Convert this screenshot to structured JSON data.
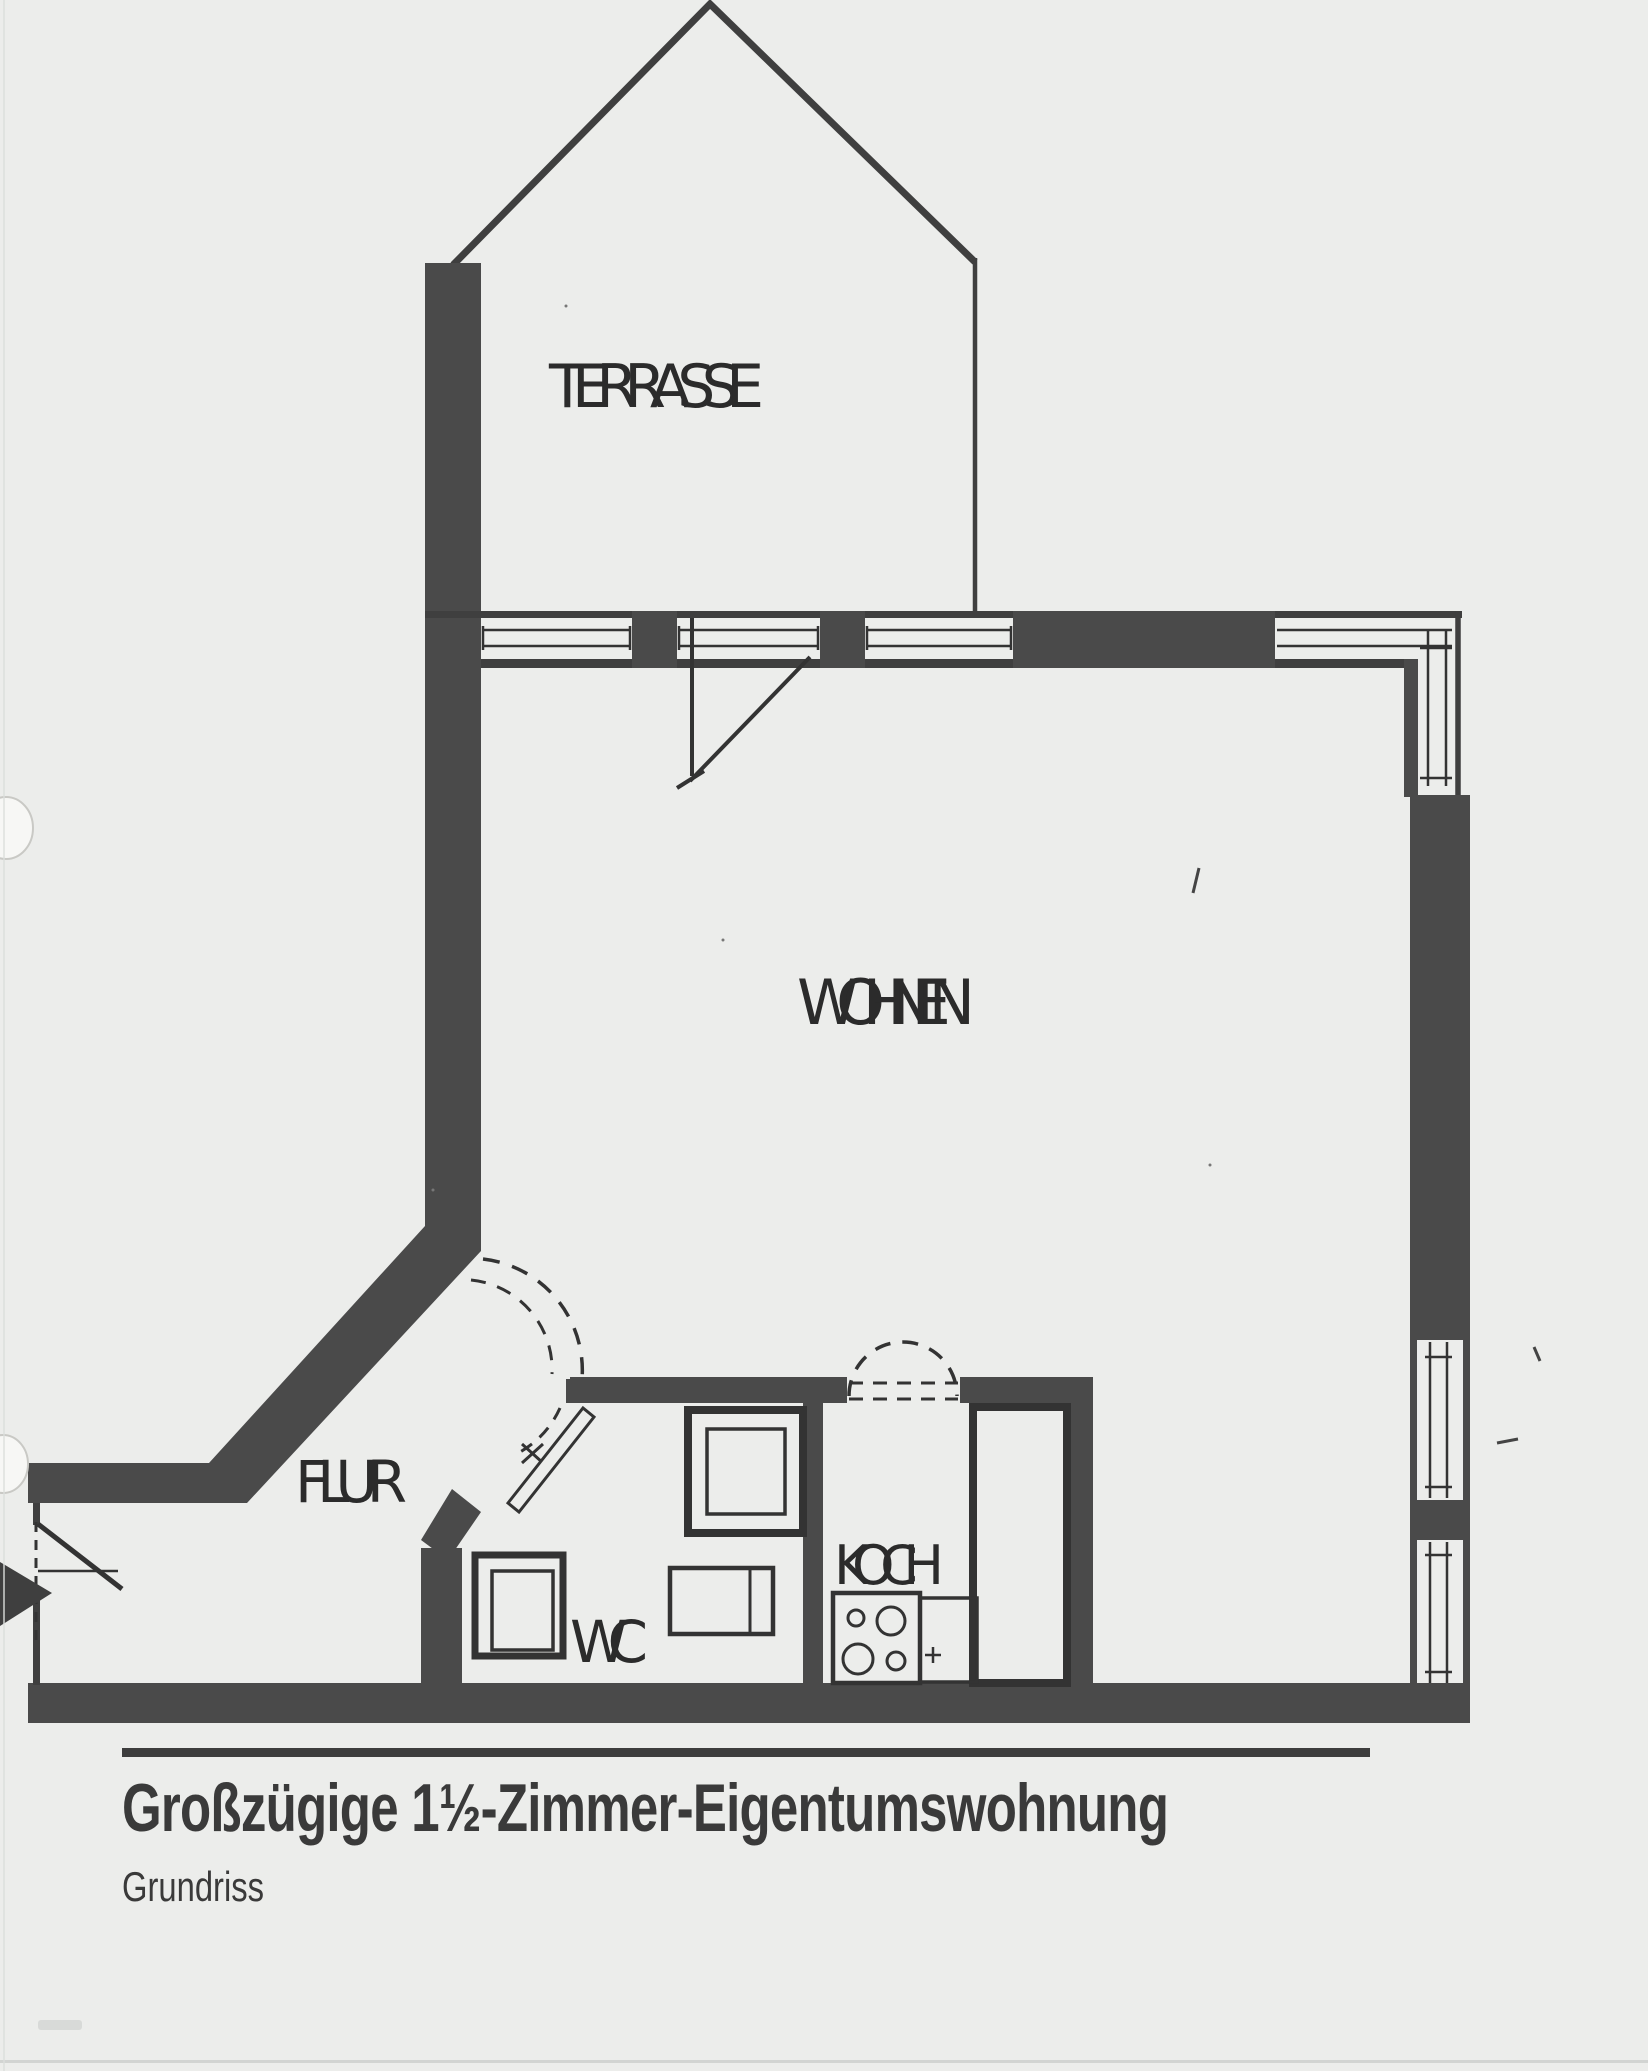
{
  "document": {
    "type": "scanned floor plan",
    "title": "Großzügige 1½-Zimmer-Eigentumswohnung",
    "subtitle": "Grundriss"
  },
  "rooms": [
    {
      "id": "terrasse",
      "label": "TERRASSE"
    },
    {
      "id": "wohnen",
      "label": "WOHNEN"
    },
    {
      "id": "flur",
      "label": "FLUR"
    },
    {
      "id": "wc",
      "label": "WC"
    },
    {
      "id": "koch",
      "label": "KOCH"
    }
  ],
  "fixtures": [
    "terrace-door",
    "entrance-door",
    "flur-curved-door",
    "wc-door",
    "koch-door-arc",
    "shower",
    "washbasin",
    "cabinet",
    "fridge",
    "stove",
    "sink"
  ],
  "colors": {
    "paper": "#ecedeb",
    "wall": "#4a4a4a",
    "line": "#333333",
    "label_text": "#2b2b2b",
    "caption_text": "#3a3a3a"
  }
}
